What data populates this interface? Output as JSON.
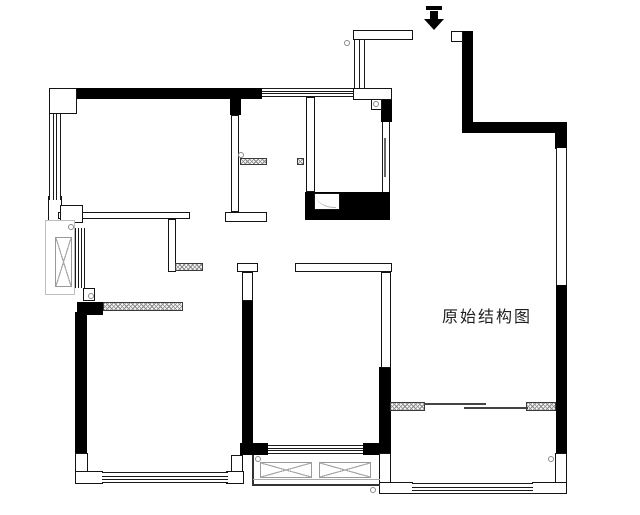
{
  "plan": {
    "title": "原始结构图",
    "entry_marker": "entrance-arrow-down",
    "colors": {
      "bearing_wall": "#000000",
      "wall_outline": "#141414",
      "hatch_stroke": "#8a8a8a",
      "light_outline": "#bdbdbd",
      "text": "#1f1f1f",
      "background": "#ffffff"
    }
  }
}
